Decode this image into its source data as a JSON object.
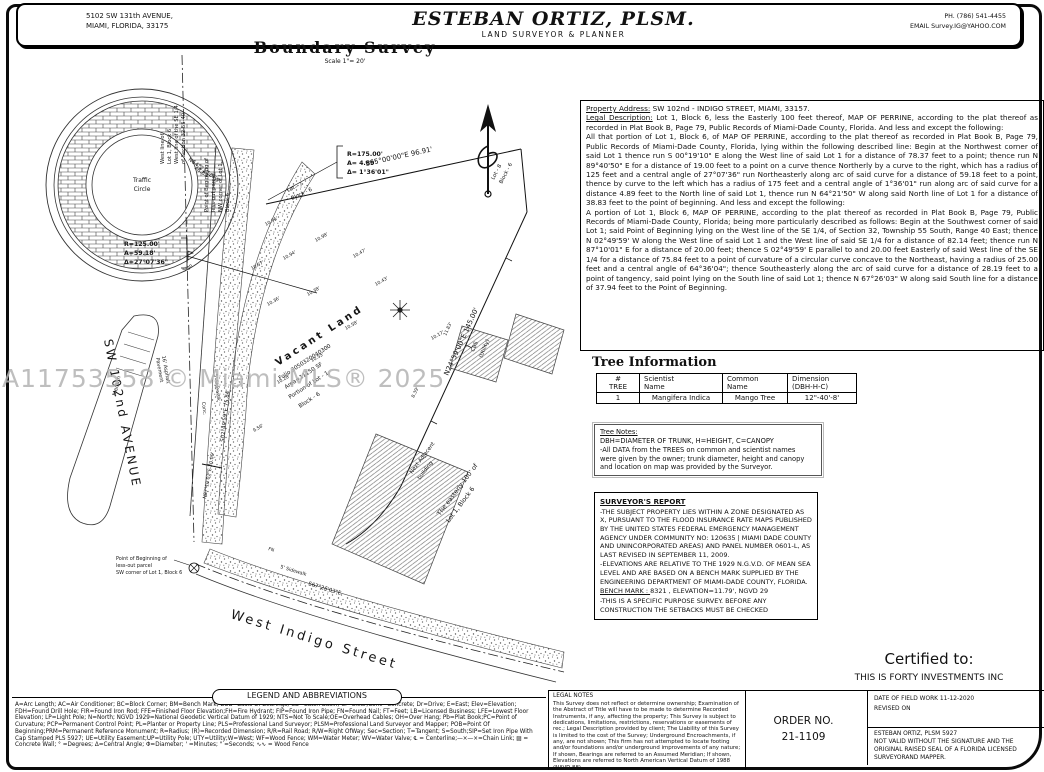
{
  "watermark": "A11753558 © Miami MLS® 2025",
  "header": {
    "address_line1": "5102 SW 131th AVENUE,",
    "address_line2": "MIAMI, FLORIDA, 33175",
    "firm_name": "ESTEBAN ORTIZ, PLSM.",
    "firm_subtitle": "LAND SURVEYOR & PLANNER",
    "phone": "PH. (786) 541-4455",
    "email": "EMAIL Survey.IG@YAHOO.COM"
  },
  "drawing": {
    "title": "Boundary Survey",
    "scale": "Scale 1\"= 20'",
    "traffic_circle_line1": "Traffic",
    "traffic_circle_line2": "Circle",
    "curve_a": {
      "r": "R=175.00'",
      "a": "A= 4.89'",
      "d": "Δ= 1°36'01\""
    },
    "curve_b": {
      "r": "R=125.00'",
      "a": "A=59.18'",
      "d": "Δ=27°07'36\""
    },
    "streets": {
      "avenue": "SW 102nd AVENUE",
      "indigo": "West Indigo Street"
    },
    "parcel": {
      "l1": "Vacant Land",
      "l2": "Folio 3050320040300",
      "l3": "Area=11150 SF",
      "l4": "Portion of Lot - 1",
      "l5": "Block - 6"
    },
    "bearings": {
      "north_line": "S65°00'00\"E   96.91'",
      "east_line": "N24°59'00\"E   145.00'",
      "west_line": "S02°49'59\"E  75.84'",
      "south_line": "S67°26'03\"E",
      "nw": "N64°21'50\"W",
      "nw_dist": "38.83'",
      "jog": "N87°10'01\"E  20.00'"
    },
    "annotations": {
      "west_line_note": [
        "West line of",
        "Lot 1, Block 6",
        "West line of the SE 1/4",
        "of Section 32-55-40"
      ],
      "pob_nw": [
        "Point of Beginning of",
        "less-out parcel",
        "NW corner of Lot 1,",
        "Block 6"
      ],
      "pob_sw": [
        "Point of Beginning of",
        "less-out parcel",
        "SW corner of Lot 1, Block 6"
      ],
      "easterly1": "The easterly 100' of",
      "easterly2": "Lot 1, Block 6",
      "next_building1": "Next Adjacent",
      "next_building2": "building",
      "cbs1": "CBS",
      "cbs2": "(Utility)",
      "lot7a": "Lot - 7",
      "lot7b": "Block - 6",
      "lot8a": "Lot - 8",
      "lot8b": "Block - 6",
      "median": "Median",
      "asphalt1": "16' Asphalt",
      "asphalt2": "Pavement",
      "sidewalk": "5' Sidewalk",
      "conc": "Conc.",
      "sign": "Sign",
      "fn": "FN"
    },
    "spots": [
      "10.96'",
      "10.57'",
      "10.94'",
      "10.98'",
      "10.47'",
      "10.36'",
      "10.38'",
      "10.17'",
      "10.43'",
      "10.58'",
      "10.55'",
      "10.28'",
      "9.56'",
      "11.83'",
      "8.39'"
    ]
  },
  "property": {
    "address_label": "Property Address:",
    "address_value": " SW 102nd - INDIGO STREET, MIAMI, 33157.",
    "legal_label": "Legal Description:",
    "legal_p1": " Lot 1, Block 6, less the Easterly 100 feet thereof, MAP OF PERRINE, according to the plat thereof as recorded in Plat Book B, Page 79, Public Records of Miami-Dade County, Florida. And less and except the following:",
    "legal_p2": "All that portion of Lot 1, Block 6, of MAP OF PERRINE, according to the plat thereof as recorded in Plat Book B, Page 79, Public Records of Miami-Dade County, Florida, lying within the following described line: Begin at the Northwest corner of said Lot 1 thence run S 00°19'10\" E along the West line of said Lot 1 for a distance of 78.37 feet to a point; thence run N 89°40'50\" E for a distance of 19.00 feet to a point on a curve thence Northerly by a curve to the right, which has a radius of 125 feet and a central angle of 27°07'36\" run Northeasterly along arc of said curve for a distance of 59.18 feet to a point, thence by curve to the left which has a radius of 175 feet and a central angle of 1°36'01\" run along arc of said curve for a distance 4.89 feet to the North line of said Lot 1, thence run N 64°21'50\" W along said North line of Lot 1 for a distance of 38.83 feet to the point of beginning. And less and except the following:",
    "legal_p3": "A portion of Lot 1, Block 6, MAP OF PERRINE, according to the plat thereof as recorded in Plat Book B, Page 79, Public Records of Miami-Dade County, Florida; being more particularly described as follows: Begin at the Southwest corner of said Lot 1; said Point of Beginning lying on the West line of the SE 1/4, of Section 32, Township 55 South, Range 40 East; thence N 02°49'59' W along the West line of said Lot 1 and the West line of said SE 1/4 for a distance of 82.14 feet; thence run N 87°10'01\" E for a distance of 20.00 feet; thence S 02°49'59' E parallel to and 20.00 feet Easterly of said West line of the SE 1/4 for a distance of 75.84 feet to a point of curvature of a circular curve concave to the Northeast, having a radius of 25.00 feet and a central angle of 64°36'04\"; thence Southeasterly along the arc of said curve for a distance of 28.19 feet to a point of tangency, said point lying on the South line of said Lot 1; thence N 67°26'03\" W along said South line for a distance of 37.94 feet to the Point of Beginning."
  },
  "tree_info": {
    "title": "Tree Information",
    "headers": [
      [
        "#",
        "TREE"
      ],
      [
        "Scientist",
        "Name"
      ],
      [
        "Common",
        "Name"
      ],
      [
        "Dimension",
        "(DBH-H-C)"
      ]
    ],
    "row": [
      "1",
      "Mangifera Indica",
      "Mango Tree",
      "12\"-40'-8'"
    ]
  },
  "tree_notes": {
    "title": "Tree Notes:",
    "body": "DBH=DIAMETER OF TRUNK, H=HEIGHT, C=CANOPY\n-All DATA from the TREES on common and scientist names\nwere given by the owner; trunk diameter, height and canopy\nand location on map was provided by the Surveyor."
  },
  "surveyors_report": {
    "title": "SURVEYOR'S REPORT",
    "p1": "-THE SUBJECT PROPERTY LIES WITHIN A ZONE DESIGNATED AS X, PURSUANT TO THE FLOOD INSURANCE RATE MAPS PUBLISHED BY THE UNITED STATES FEDERAL EMERGENCY MANAGEMENT AGENCY UNDER COMMUNITY NO: 120635 | MIAMI DADE COUNTY AND UNINCORPORATED AREAS) AND PANEL NUMBER 0601-L, AS LAST REVISED IN SEPTEMBER 11, 2009.",
    "p2": "-ELEVATIONS ARE RELATIVE TO THE 1929 N.G.V.D. OF MEAN SEA LEVEL AND ARE BASED ON A BENCH MARK SUPPLIED BY THE ENGINEERING DEPARTMENT OF MIAMI-DADE COUNTY, FLORIDA.",
    "bench_label": "BENCH MARK : ",
    "bench_value": "8321 ,  ELEVATION=11.79',   NGVD 29",
    "p3": "-THIS IS A SPECIFIC PURPOSE SURVEY. BEFORE ANY CONSTRUCTION THE SETBACKS MUST BE CHECKED"
  },
  "certified": {
    "label": "Certified to:",
    "name": "THIS IS FORTY INVESTMENTS INC"
  },
  "legend": {
    "title": "LEGEND AND ABBREVIATIONS",
    "text": "A=Arc Length; AC=Air Conditioner; BC=Block Corner; BM=Bench Mark; BOB=Basis Of Bearings; CB=Catch Basin; Cl=Clear;Conc=Concrete; Dr=Drive; E=East; Elev=Elevation; FDH=Found Drill Hole; FIR=Found Iron Rod; FFE=Finished Floor Elevation;FH=Fire Hydrant; FIP=Found Iron Pipe; FN=Found Nail; FT=Feet; LB=Licensed Business; LFE=Lowest Floor Elevation; LP=Light Pole; N=North; NGVD 1929=National Geodetic Vertical Datum of 1929; NTS=Not To Scale;OE=Overhead Cables; OH=Over Hang; Pb=Plat Book;PC=Point of Curvature; PCP=Permanent Control Point; PL=Planter or Property Line; PLS=Professional Land Surveyor; PLSM=Professional Land Surveyor and Mapper; POB=Point Of Beginning;PRM=Permanent Reference Monument; R=Radius; (R)=Recorded Dimension; R/R=Rail Road; R/W=Right OfWay; Sec=Section; T=Tangent; S=South;SIP=Set Iron Pipe With Cap Stamped PLS 5927; UE=Utility Easement;UP=Utility Pole; UTY=Utility;W=West; WF=Wood Fence; WM=Water Meter; WV=Water Valve; ℄ = Centerline;—×—×=Chain Link; ▨ = Concrete Wall; ° =Degrees; Δ=Central Angle; Φ=Diameter; ' =Minutes; \" =Seconds; ∿∿ = Wood Fence"
  },
  "legal_notes": {
    "title": "LEGAL NOTES",
    "body": "This Survey does not reflect or determine ownership; Examination of the Abstract of Title will have to be made to determine Recorded Instruments, if any, affecting the property; This Survey is subject to dedications, limitations, restrictions, reservations or easements of rec.; Legal Description provided by client; The Liability of this Survey is limited to the cost of the Survey; Underground Encroachments, if any, are not shown; This firm has not attempted to locate footing and/or foundations and/or underground improvements of any nature; If shown, Bearings are referred to an Assumed Meridian; If shown, Elevations are referred to North American Vertical Datum of 1988 (NAVD 88)."
  },
  "order": {
    "label": "ORDER NO.",
    "number": "21-1109"
  },
  "field_work": {
    "line1": "DATE OF FIELD WORK   11-12-2020",
    "line2": "REVISED ON"
  },
  "validity": {
    "line1": "ESTEBAN ORTIZ,  PLSM   5927",
    "line2": "NOT VALID WITHOUT THE SIGNATURE AND THE ORIGINAL RAISED SEAL OF A FLORIDA LICENSED SURVEYORAND MAPPER."
  }
}
